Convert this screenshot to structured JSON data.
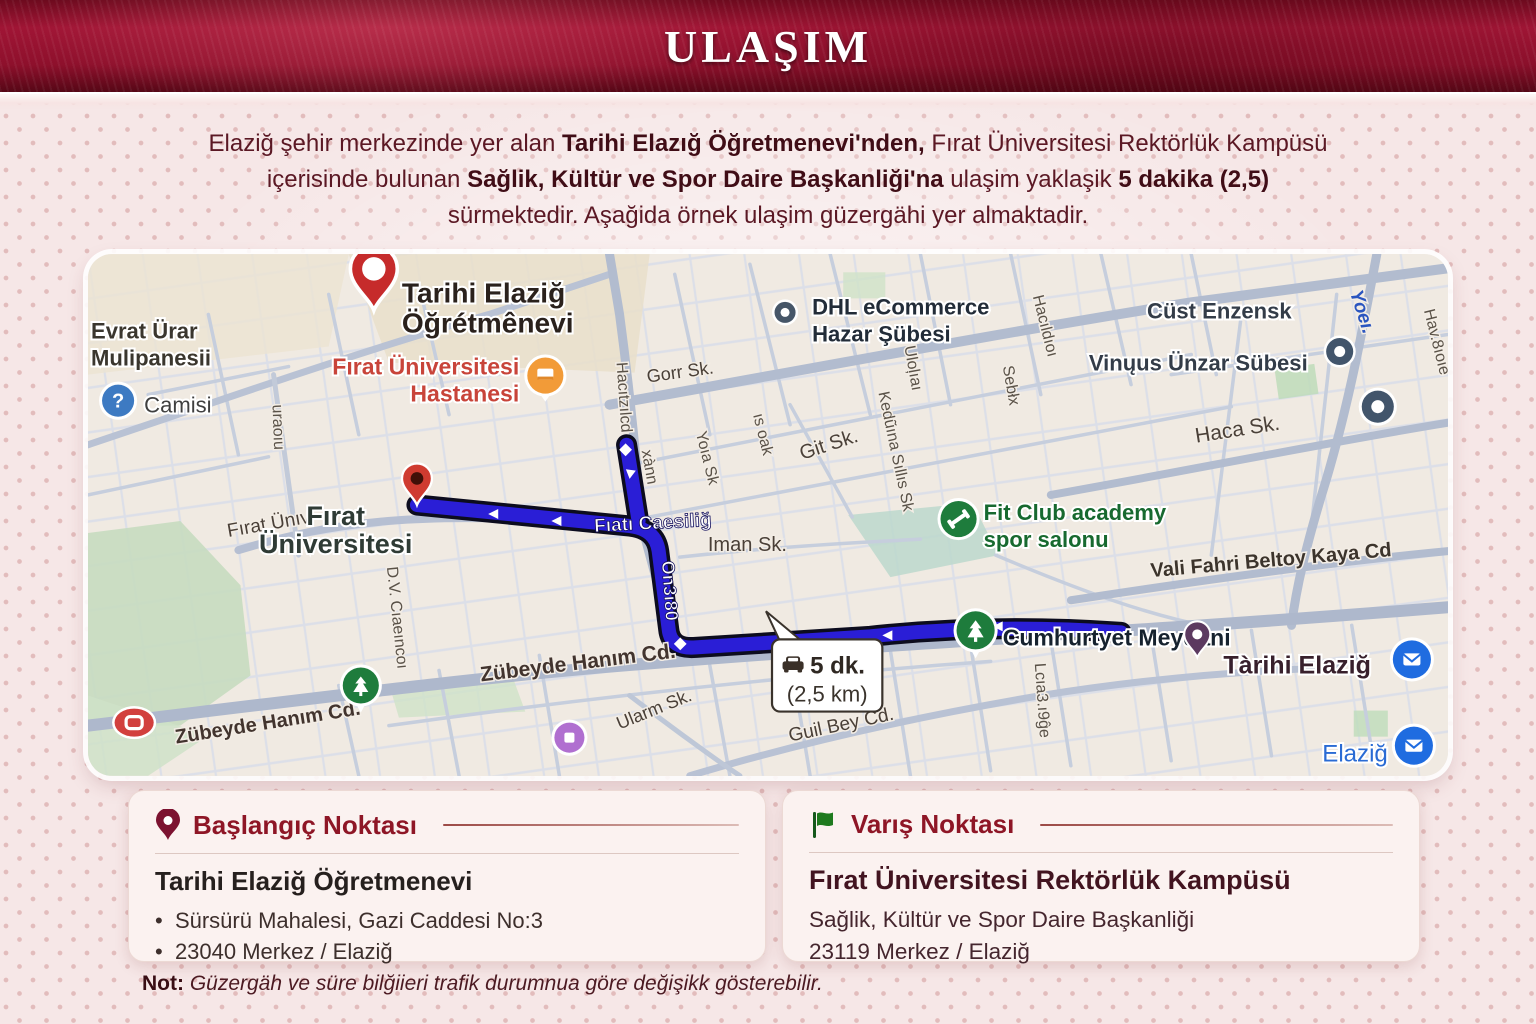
{
  "header": {
    "title": "ULAŞIM"
  },
  "intro": {
    "l1a": "Elaziğ şehir merkezinde yer alan ",
    "l1b": "Tarihi Elazığ Öğretmenevi'nden,",
    "l1c": " Fırat Üniversitesi Rektörlük Kampüsü",
    "l2a": "içerisinde bulunan ",
    "l2b": "Sağlik, Kültür ve Spor Daire Başkanliği'na",
    "l2c": " ulaşim yaklaşik ",
    "l2d": "5 dakika (2,5)",
    "l3": "sürmektedir. Aşağida örnek ulaşim güzergähi yer almaktadir."
  },
  "map": {
    "tooltip": {
      "duration": "5 dk.",
      "distance": "(2,5 km)"
    },
    "route_label": "Fıatı Caesiliğ",
    "route_label_vertical": "On3ı80",
    "glyphs": {
      "question": "?"
    },
    "pois": {
      "start_pin": {
        "l1": "Tarihi Elaziğ",
        "l2": "Öğrétmênevi"
      },
      "hospital": {
        "l1": "Fırat Üniversitesi",
        "l2": "Hastanesi"
      },
      "university": {
        "l1": "Fırat",
        "l2": "Üniversitesi"
      },
      "dhl": {
        "l1": "DHL eCommerce",
        "l2": "Hazar Şübesi"
      },
      "fitclub": {
        "l1": "Fit Club academy",
        "l2": "spor salonu"
      },
      "cumhuriyet": "Cumhurtyet Meydani",
      "tarihi": "Tàrihi Elaziğ",
      "elazig": "Elaziğ",
      "evrat": {
        "l1": "Evrat Ürar",
        "l2": "Mulipanesii"
      },
      "camisi": "Camisi",
      "cust": "Cüst Enzensk",
      "vinuus": "Vinųus Ünzar Sübesi"
    },
    "streets": {
      "firat_univ": "Fırat Ünıv.",
      "gorr": "Gorr Sk.",
      "git": "Git Sk.",
      "iman": "Iman Sk.",
      "haca": "Haca Sk.",
      "vali": "Vali Fahri Beltoy Kaya Cd",
      "zubeyde1": "Zübeyde Hanım Cd.",
      "zubeyde2": "Zübeyde Hanım Cd.",
      "ularm": "Ularm Sk.",
      "guil": "Guil Bey Cd.",
      "v1": "Hacıtzılcd",
      "v2": "xànn",
      "v3": "Yoıa Sk",
      "v4": "ıs oak",
      "v5": "Kedũına Sıllıs Sk",
      "v6": "Sebłx",
      "v7": "Hacıldıoı",
      "v8": "uraoıu",
      "v9": "D.V. Cıaeıncoı",
      "v10": "Lcıa3.ı9ĝe",
      "v11": "Yoeı.",
      "v12": "Hav.8ıoıe",
      "v13": "Uloļıaı"
    }
  },
  "cards": {
    "start": {
      "title": "Başlangıç Noktası",
      "name": "Tarihi Elaziğ Öğretmenevi",
      "line1": "Sürsürü Mahalesi, Gazi Caddesi No:3",
      "line2": "23040 Merkez / Elaziğ"
    },
    "dest": {
      "title": "Varış Noktası",
      "name": "Fırat Üniversitesi Rektörlük Kampüsü",
      "line1": "Sağlik, Kültür ve Spor Daire Başkanliği",
      "line2": "23119 Merkez / Elaziğ"
    }
  },
  "note": {
    "label": "Not:",
    "text": " Güzergäh ve süre bilğiieri trafik durumnua göre değişikk gösterebilir."
  },
  "colors": {
    "banner": "#8e102c",
    "accent_red": "#8e1626",
    "route_blue": "#2a1ed6",
    "flag_green": "#1e7a1e",
    "poi_green": "#1e7c3c",
    "mail_blue": "#1f6ce0"
  }
}
